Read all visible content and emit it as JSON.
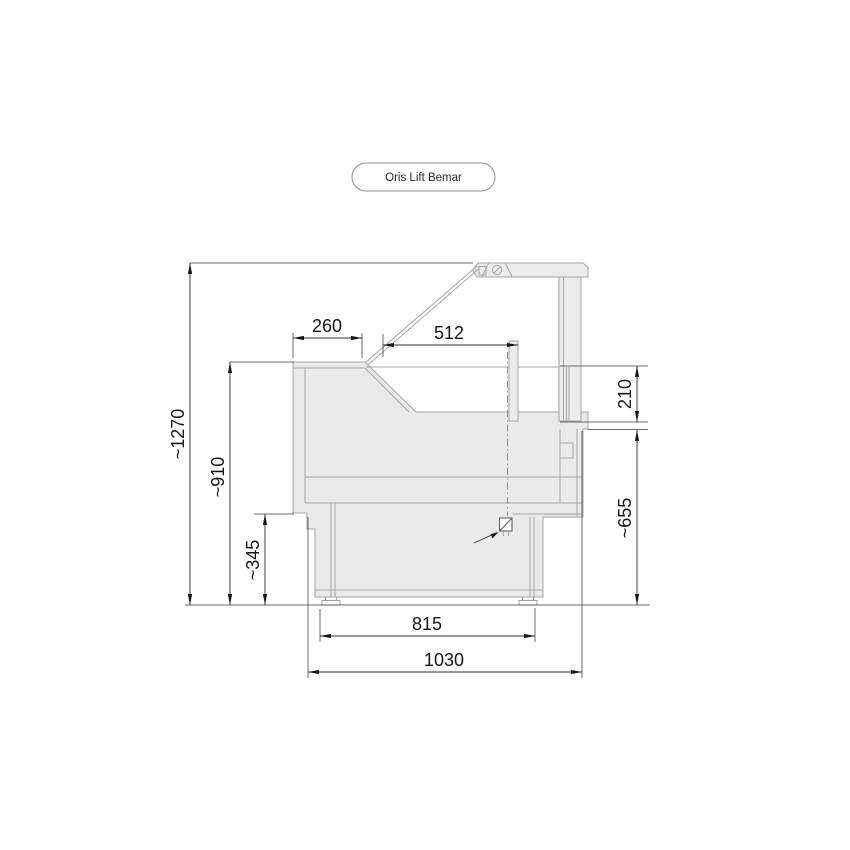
{
  "page": {
    "background": "#ffffff"
  },
  "header": {
    "product_label": "Oris Lift Bemar"
  },
  "diagram": {
    "type": "technical side-section drawing of a lift-glass bain-marie display counter",
    "dimensions": {
      "total_height": "~1270",
      "body_height": "~910",
      "front_panel_height": "~345",
      "front_top_depth": "260",
      "glass_width": "512",
      "pass_opening_height": "210",
      "serve_counter_height": "~655",
      "base_depth": "815",
      "overall_depth": "1030"
    },
    "colors": {
      "outline": "#a5a5a5",
      "body_fill": "#eaeaea",
      "dimension_line": "#2e2e2e",
      "label_text": "#161616"
    }
  }
}
